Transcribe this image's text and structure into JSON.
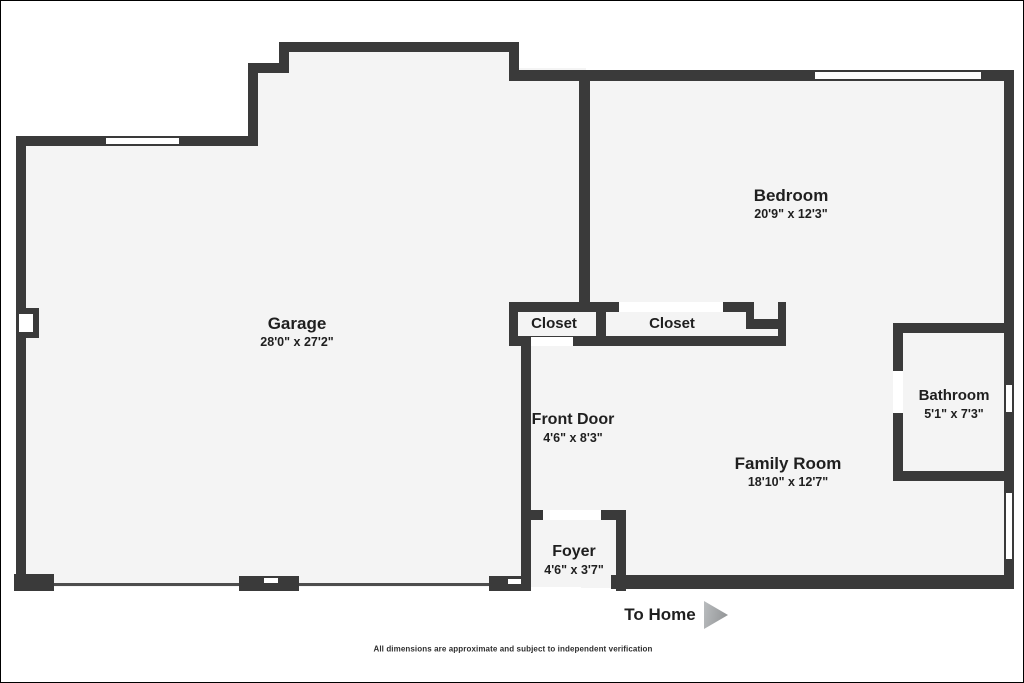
{
  "colors": {
    "wall": "#3a3a3a",
    "floor": "#f4f4f4",
    "text": "#1f1f1f",
    "arrow": "#9a9d9f"
  },
  "rooms": [
    {
      "id": "garage",
      "label": "Garage",
      "dims": "28'0\" x 27'2\""
    },
    {
      "id": "bedroom",
      "label": "Bedroom",
      "dims": "20'9\" x 12'3\""
    },
    {
      "id": "closet-1",
      "label": "Closet",
      "dims": ""
    },
    {
      "id": "closet-2",
      "label": "Closet",
      "dims": ""
    },
    {
      "id": "front-door",
      "label": "Front Door",
      "dims": "4'6\" x 8'3\""
    },
    {
      "id": "family-room",
      "label": "Family Room",
      "dims": "18'10\" x 12'7\""
    },
    {
      "id": "bathroom",
      "label": "Bathroom",
      "dims": "5'1\" x 7'3\""
    },
    {
      "id": "foyer",
      "label": "Foyer",
      "dims": "4'6\" x 3'7\""
    }
  ],
  "footer": {
    "to_home": "To Home",
    "disclaimer": "All dimensions are approximate and subject to independent verification"
  },
  "floorplan": {
    "floors": [
      [
        283,
        45,
        230,
        35
      ],
      [
        252,
        67,
        333,
        75
      ],
      [
        20,
        140,
        565,
        446
      ],
      [
        580,
        75,
        428,
        512
      ]
    ],
    "walls": [
      [
        15,
        135,
        10,
        455
      ],
      [
        15,
        135,
        88,
        10
      ],
      [
        180,
        135,
        77,
        10
      ],
      [
        247,
        62,
        10,
        83
      ],
      [
        247,
        62,
        41,
        10
      ],
      [
        278,
        41,
        10,
        31
      ],
      [
        278,
        41,
        240,
        10
      ],
      [
        508,
        41,
        10,
        38
      ],
      [
        508,
        69,
        304,
        11
      ],
      [
        982,
        69,
        31,
        11
      ],
      [
        1003,
        69,
        10,
        313
      ],
      [
        1003,
        413,
        10,
        77
      ],
      [
        1003,
        560,
        10,
        28
      ],
      [
        578,
        77,
        11,
        224
      ],
      [
        508,
        301,
        110,
        10
      ],
      [
        722,
        301,
        31,
        10
      ],
      [
        745,
        301,
        8,
        27
      ],
      [
        745,
        318,
        40,
        10
      ],
      [
        777,
        301,
        8,
        44
      ],
      [
        595,
        301,
        10,
        44
      ],
      [
        508,
        301,
        9,
        44
      ],
      [
        508,
        335,
        277,
        10
      ],
      [
        520,
        345,
        10,
        245
      ],
      [
        528,
        509,
        16,
        10
      ],
      [
        600,
        509,
        25,
        10
      ],
      [
        615,
        509,
        10,
        81
      ],
      [
        488,
        575,
        42,
        15
      ],
      [
        13,
        573,
        40,
        17
      ],
      [
        238,
        575,
        60,
        15
      ],
      [
        610,
        574,
        403,
        14
      ],
      [
        892,
        322,
        121,
        10
      ],
      [
        892,
        322,
        10,
        48
      ],
      [
        892,
        412,
        10,
        66
      ],
      [
        892,
        470,
        121,
        10
      ],
      [
        15,
        307,
        23,
        30
      ]
    ],
    "door_lines": [
      [
        53,
        582,
        185,
        3
      ],
      [
        298,
        582,
        190,
        3
      ]
    ],
    "windows": [
      [
        103,
        135,
        77,
        10
      ],
      [
        812,
        69,
        170,
        11
      ],
      [
        1003,
        382,
        10,
        31
      ],
      [
        1003,
        490,
        10,
        70
      ]
    ],
    "openings": [
      [
        618,
        301,
        104,
        10
      ],
      [
        530,
        336,
        42,
        9
      ],
      [
        542,
        509,
        58,
        10
      ],
      [
        892,
        370,
        10,
        42
      ],
      [
        18,
        313,
        14,
        18
      ],
      [
        507,
        578,
        13,
        5
      ],
      [
        263,
        577,
        14,
        5
      ]
    ]
  }
}
